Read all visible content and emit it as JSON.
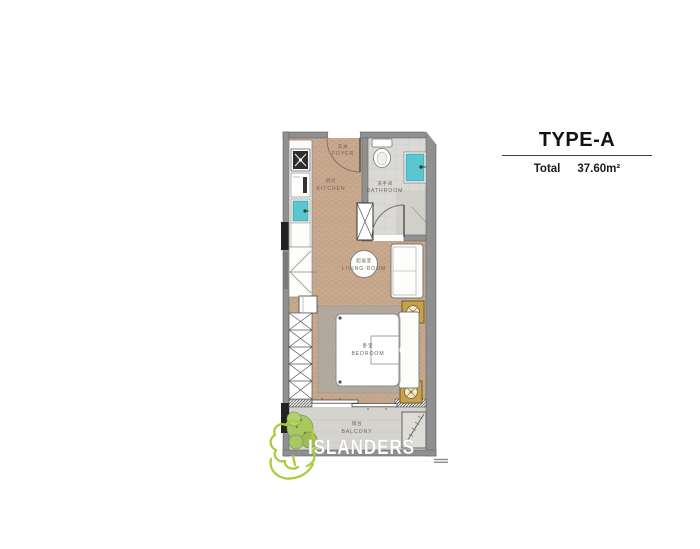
{
  "header": {
    "title": "TYPE-A",
    "total_label": "Total",
    "total_value": "37.60m²"
  },
  "floor_plan": {
    "rooms": {
      "foyer": {
        "zh": "玄关",
        "en": "FOYER"
      },
      "kitchen": {
        "zh": "厨房",
        "en": "KITCHEN"
      },
      "bathroom": {
        "zh": "洗手间",
        "en": "BATHROOM"
      },
      "living_room": {
        "zh": "起居室",
        "en": "LIVING ROOM"
      },
      "bedroom": {
        "zh": "卧室",
        "en": "BEDROOM"
      },
      "balcony": {
        "zh": "阳台",
        "en": "BALCONY"
      }
    },
    "fixtures": [
      "entry-door",
      "stove",
      "oven",
      "kitchen-sink",
      "counter",
      "dressing-desk",
      "stool",
      "wardrobe",
      "hall-cabinet",
      "bathroom-door",
      "toilet",
      "bathroom-sink",
      "shower",
      "round-table",
      "sofa",
      "side-table-lamp-1",
      "side-table-lamp-2",
      "bed",
      "rug",
      "sliding-door",
      "plant",
      "drying-rack"
    ]
  },
  "watermark": {
    "brand": "ISLANDERS",
    "tagline": "········· ·············· · ······ ····· ·······"
  },
  "colors": {
    "wall": "#909090",
    "wood_floor": "#c9a98d",
    "tile_floor": "#dad9d5",
    "balcony_floor": "#d4d3ce",
    "rug": "#b5ada2",
    "teal_fixture": "#5ac6cf",
    "gold_table": "#c8a24b",
    "logo_green": "#a9cd3d",
    "text": "#111111"
  }
}
